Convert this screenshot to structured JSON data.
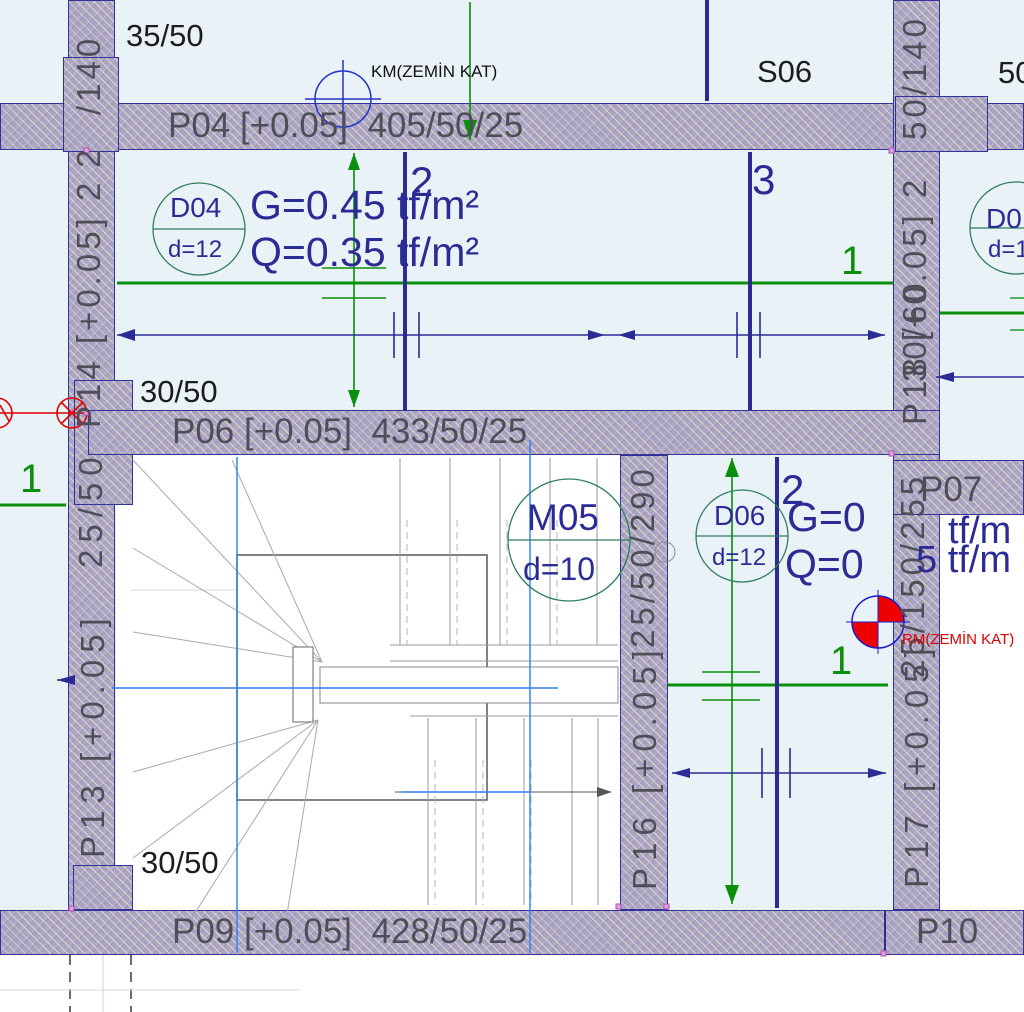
{
  "symbols": {
    "km_label": "KM(ZEMİN KAT)",
    "rm_label": "RM(ZEMİN KAT)"
  },
  "slabs": {
    "s06": "S06",
    "d35_50": "35/50",
    "d30_50_top": "30/50",
    "d30_50_bottom": "30/50",
    "d50_fragment": "50"
  },
  "beams": {
    "p04": "P04 [+0.05]  405/50/25",
    "p06": "P06 [+0.05]  433/50/25",
    "p09": "P09 [+0.05]  428/50/25",
    "p10": "P10",
    "p07": "P07"
  },
  "walls": {
    "left_col_top": "/140",
    "left_col_top_frag": "2",
    "p14": "P14 [+0.05] 2",
    "left_mid": "25/50",
    "p13": "P13 [+0.05]",
    "right_col_top": "50/140",
    "p18": "P18 [+0.05] 2",
    "p18_overlap": "30/60",
    "right_mid": "25/150/255",
    "p17": "P17 [+0.05]",
    "p16_dim": "25/50/290",
    "p16": "P16 [+0.05]"
  },
  "loads": {
    "d04": {
      "id": "D04",
      "dia": "d=12",
      "g": "G=0.45 tf/m²",
      "q": "Q=0.35 tf/m²"
    },
    "d06": {
      "id": "D06",
      "dia": "d=12",
      "g": "G=0",
      "q": "Q=0"
    },
    "d06_frag": {
      "line1": "tf/m",
      "line2": "5 tf/m"
    },
    "d05": {
      "id": "D0",
      "dia": "d=1"
    },
    "m05": {
      "id": "M05",
      "dia": "d=10"
    }
  },
  "axis_labels": {
    "a2_top": "2",
    "a3": "3",
    "a2_bottom": "2",
    "a1_right": "1",
    "a1_mid": "1",
    "a1_left": "1"
  },
  "colors": {
    "wall_fill": "#a9a4c6",
    "wall_border": "#32329a",
    "navy": "#2b2b96",
    "green": "#0a8f0a",
    "teal": "#2e7d5e",
    "blue": "#2f7cf0",
    "red": "#e00000",
    "text_gray": "#4e4e58"
  }
}
